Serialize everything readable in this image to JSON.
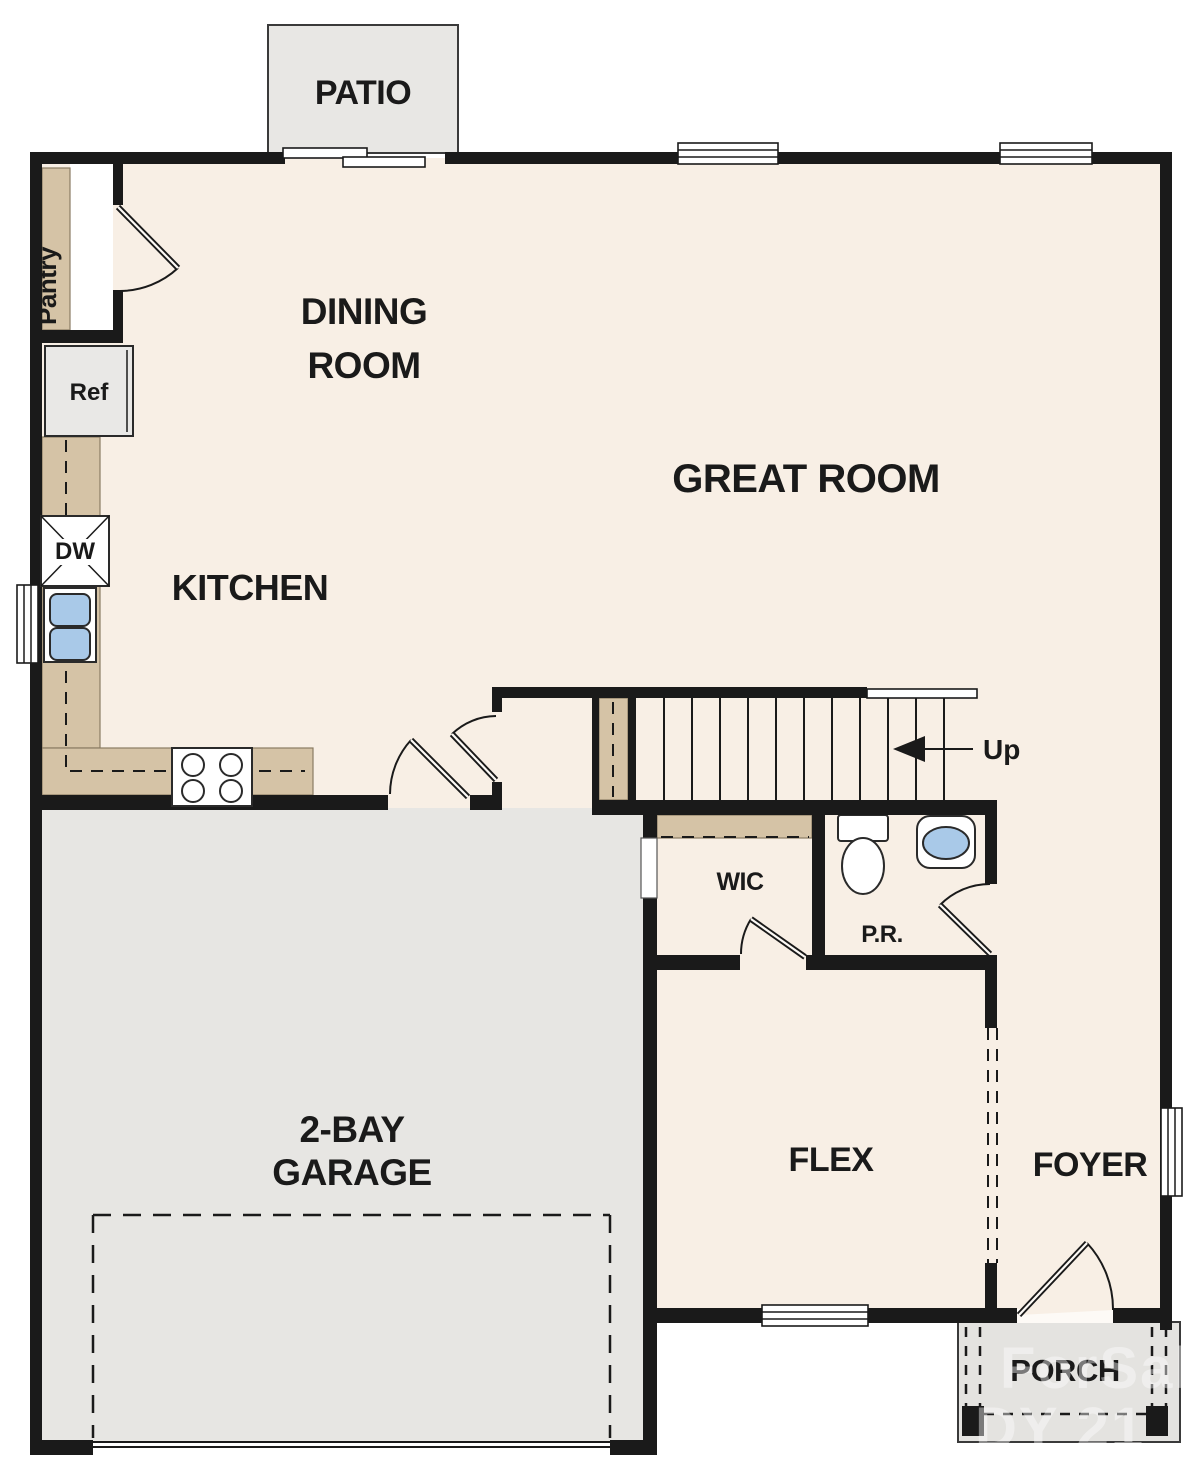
{
  "title": "First Floor Plan",
  "colors": {
    "background": "#ffffff",
    "floor": "#f8efe5",
    "wall": "#1a1a1a",
    "counter": "#d5c3a6",
    "garage_floor": "#e7e6e3",
    "patio_floor": "#e8e7e4",
    "porch_floor": "#e4e3e0",
    "appliance_gray": "#e9e8e6",
    "fixture_blue": "#a9c9e8",
    "label_text": "#1a1a1a",
    "watermark": "#ffffff"
  },
  "rooms": {
    "patio": {
      "label": "PATIO"
    },
    "dining": {
      "line1": "DINING",
      "line2": "ROOM"
    },
    "great": {
      "label": "GREAT ROOM"
    },
    "kitchen": {
      "label": "KITCHEN"
    },
    "pantry": {
      "label": "Pantry"
    },
    "garage": {
      "line1": "2-BAY",
      "line2": "GARAGE"
    },
    "wic": {
      "label": "WIC"
    },
    "powder": {
      "label": "P.R."
    },
    "flex": {
      "label": "FLEX"
    },
    "foyer": {
      "label": "FOYER"
    },
    "porch": {
      "label": "PORCH"
    }
  },
  "fixtures": {
    "refrigerator": "Ref",
    "dishwasher": "DW",
    "stairs_direction": "Up"
  },
  "watermark": {
    "line1": "ForSale",
    "line2": "DY 21"
  }
}
